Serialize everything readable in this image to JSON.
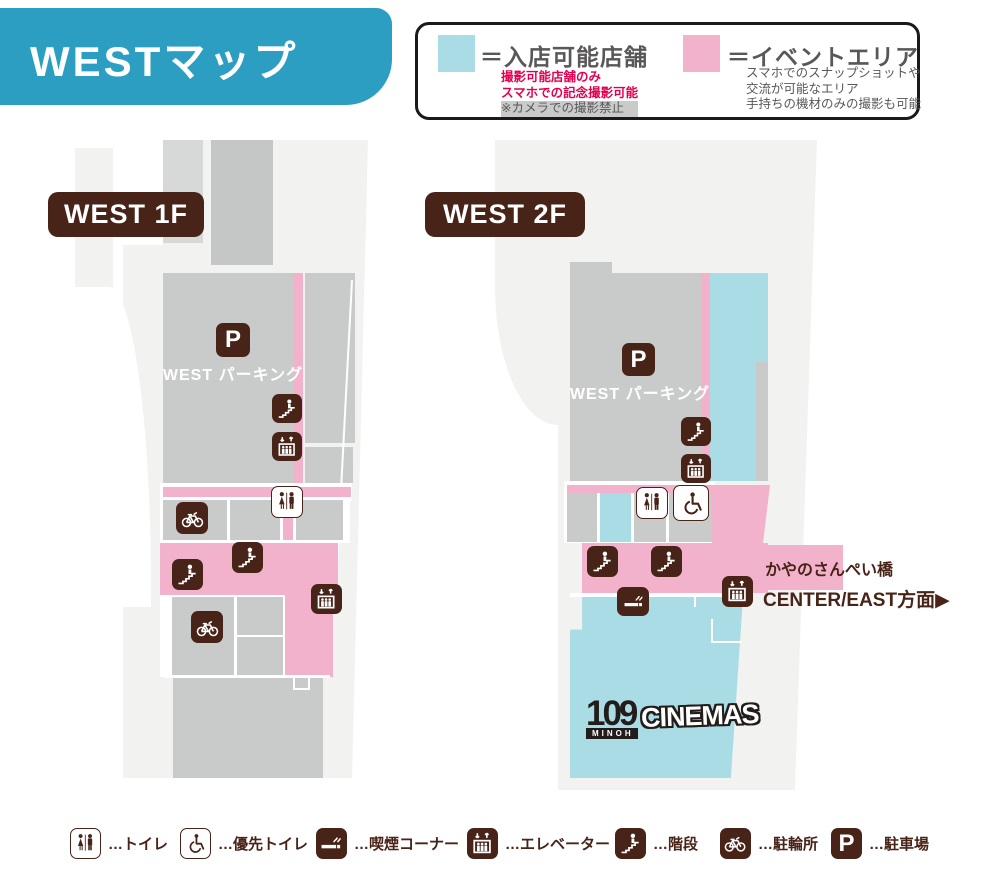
{
  "header": {
    "title": "WESTマップ"
  },
  "legend_box": {
    "store": {
      "title": "＝入店可能店舗",
      "note_red_1": "撮影可能店舗のみ",
      "note_red_2": "スマホでの記念撮影可能",
      "note_gray": "※カメラでの撮影禁止",
      "swatch_color": "#A9DCE5"
    },
    "event": {
      "title": "＝イベントエリア",
      "note_1": "スマホでのスナップショットや",
      "note_2": "交流が可能なエリア",
      "note_3": "手持ちの機材のみの撮影も可能",
      "swatch_color": "#F3B2CB"
    }
  },
  "floors": {
    "f1": {
      "label": "WEST 1F",
      "parking_label": "WEST パーキング"
    },
    "f2": {
      "label": "WEST 2F",
      "parking_label": "WEST パーキング",
      "bridge_label": "かやのさんぺい橋",
      "direction_label": "CENTER/EAST方面▶",
      "cinema": {
        "number": "109",
        "region": "MINOH",
        "word": "CINEMAS"
      }
    }
  },
  "map_legend": {
    "items": [
      {
        "icon": "toilet",
        "label": "…トイレ"
      },
      {
        "icon": "wheelchair",
        "label": "…優先トイレ"
      },
      {
        "icon": "smoking",
        "label": "…喫煙コーナー"
      },
      {
        "icon": "elevator",
        "label": "…エレベーター"
      },
      {
        "icon": "stairs",
        "label": "…階段"
      },
      {
        "icon": "bicycle",
        "label": "…駐輪所"
      },
      {
        "icon": "parking",
        "label": "…駐車場"
      }
    ]
  },
  "icons": {
    "parking_letter": "P"
  },
  "colors": {
    "header_teal": "#2B9EC1",
    "brown": "#482317",
    "store_blue": "#A9DCE5",
    "event_pink": "#F3B2CB",
    "parking_gray": "#C9CACA",
    "note_red": "#E4004F",
    "text_gray": "#595757"
  }
}
